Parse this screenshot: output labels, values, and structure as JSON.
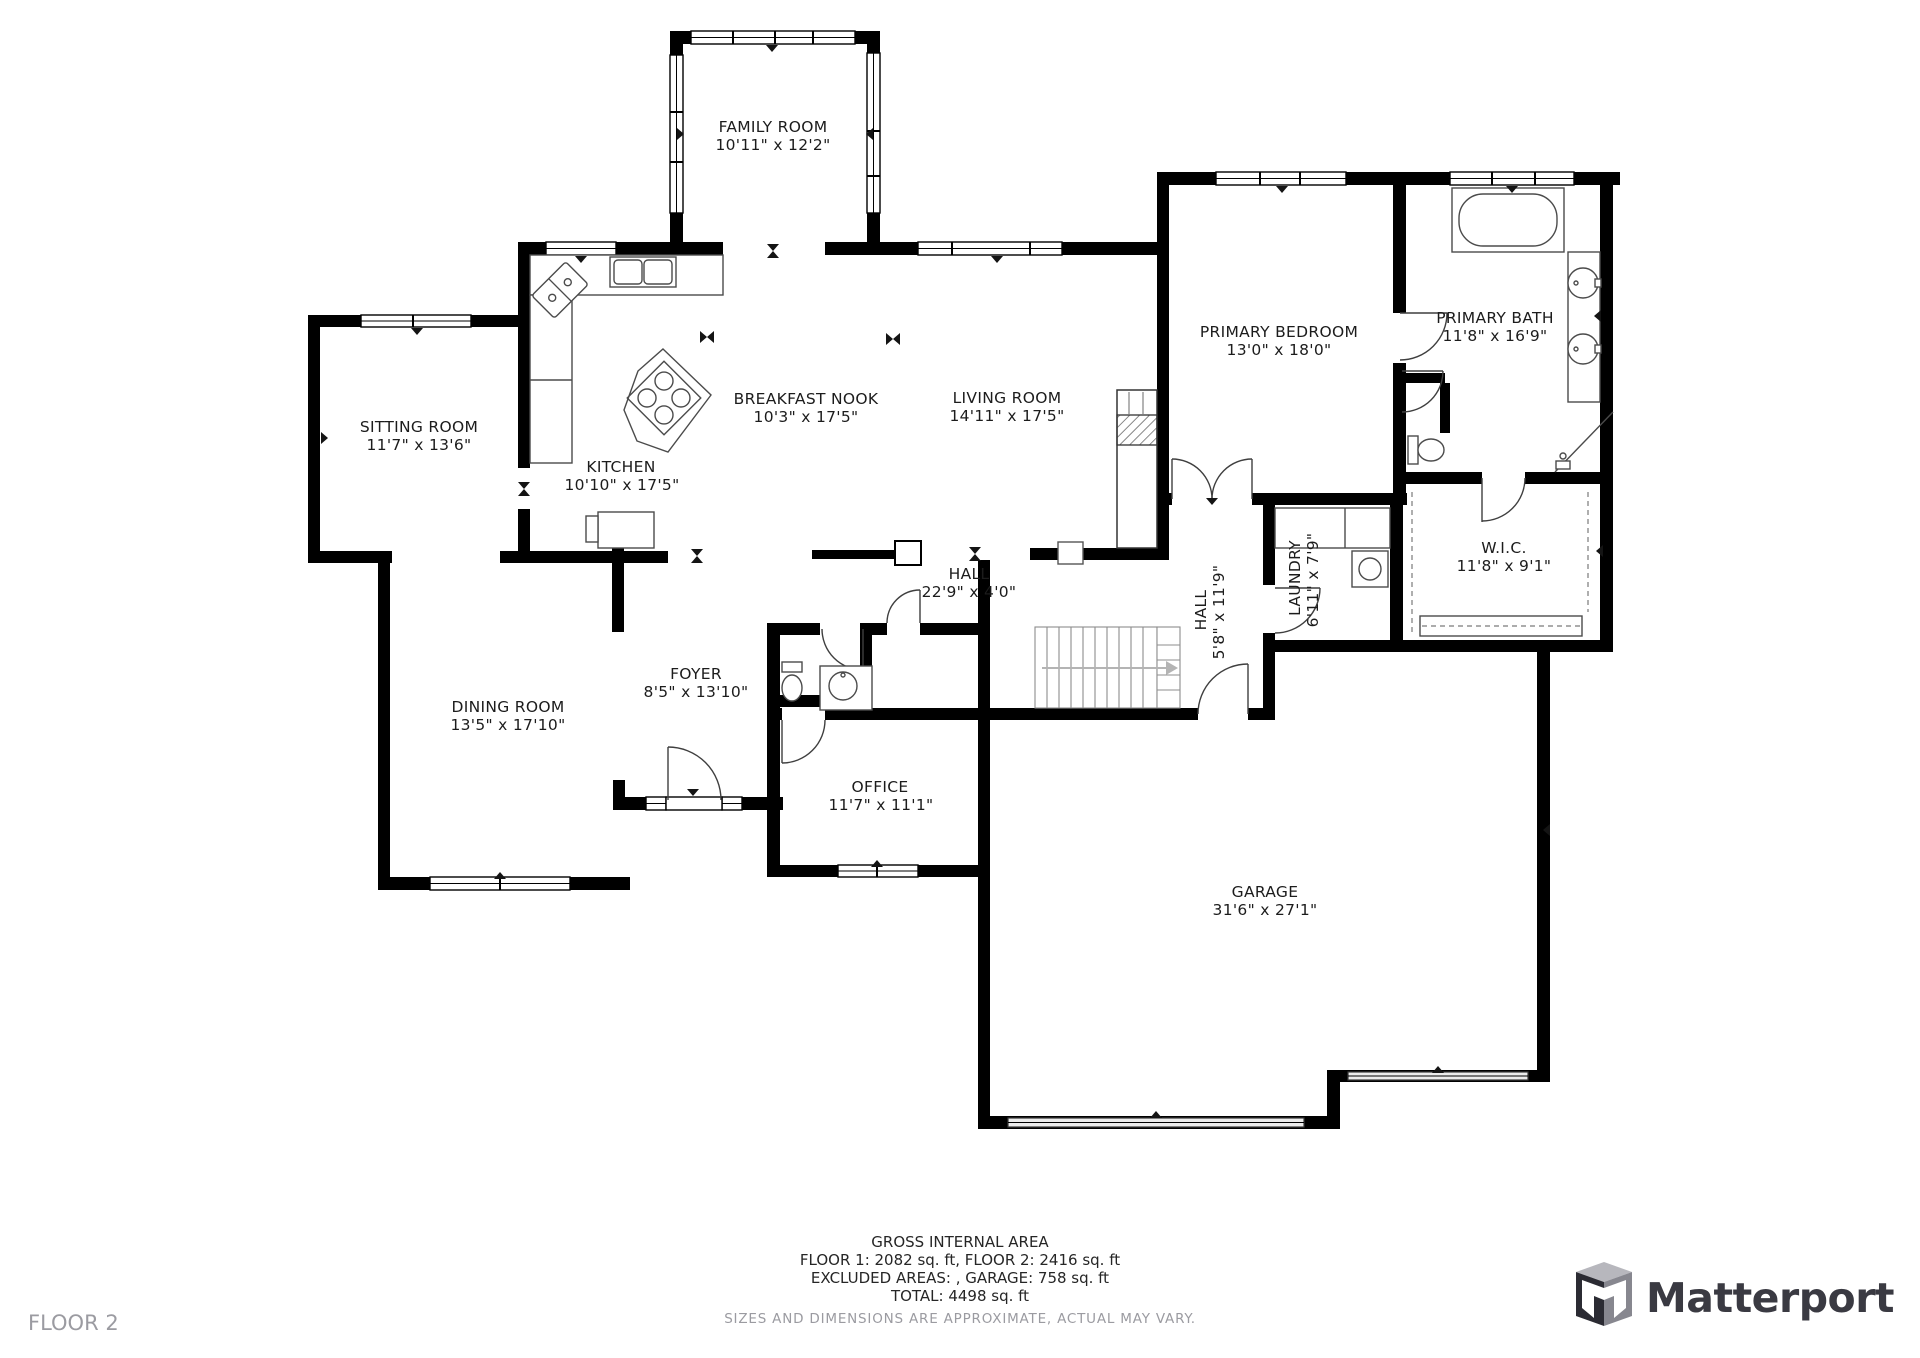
{
  "floor_label": "FLOOR 2",
  "brand": {
    "logo_text": "Matterport"
  },
  "footer": {
    "line1": "GROSS INTERNAL AREA",
    "line2": "FLOOR 1: 2082 sq. ft, FLOOR 2: 2416 sq. ft",
    "line3": "EXCLUDED AREAS: , GARAGE: 758 sq. ft",
    "line4": "TOTAL: 4498 sq. ft",
    "disclaimer": "SIZES AND DIMENSIONS ARE APPROXIMATE, ACTUAL MAY VARY."
  },
  "colors": {
    "wall": "#000000",
    "label_text": "#1c1c1c",
    "muted_text": "#9b9ba1",
    "brand_text": "#3a3a42",
    "fixture_line": "#4b4b4b"
  },
  "rooms": [
    {
      "name": "FAMILY ROOM",
      "dims": "10'11\" x 12'2\""
    },
    {
      "name": "SITTING ROOM",
      "dims": "11'7\" x 13'6\""
    },
    {
      "name": "KITCHEN",
      "dims": "10'10\" x 17'5\""
    },
    {
      "name": "BREAKFAST NOOK",
      "dims": "10'3\" x 17'5\""
    },
    {
      "name": "LIVING ROOM",
      "dims": "14'11\" x 17'5\""
    },
    {
      "name": "PRIMARY BEDROOM",
      "dims": "13'0\" x 18'0\""
    },
    {
      "name": "PRIMARY BATH",
      "dims": "11'8\" x 16'9\""
    },
    {
      "name": "W.I.C.",
      "dims": "11'8\" x 9'1\""
    },
    {
      "name": "HALL",
      "dims": "22'9\" x 4'0\""
    },
    {
      "name": "HALL",
      "dims": "5'8\" x 11'9\""
    },
    {
      "name": "LAUNDRY",
      "dims": "6'11\" x 7'9\""
    },
    {
      "name": "FOYER",
      "dims": "8'5\" x 13'10\""
    },
    {
      "name": "DINING ROOM",
      "dims": "13'5\" x 17'10\""
    },
    {
      "name": "OFFICE",
      "dims": "11'7\" x 11'1\""
    },
    {
      "name": "GARAGE",
      "dims": "31'6\" x 27'1\""
    }
  ]
}
